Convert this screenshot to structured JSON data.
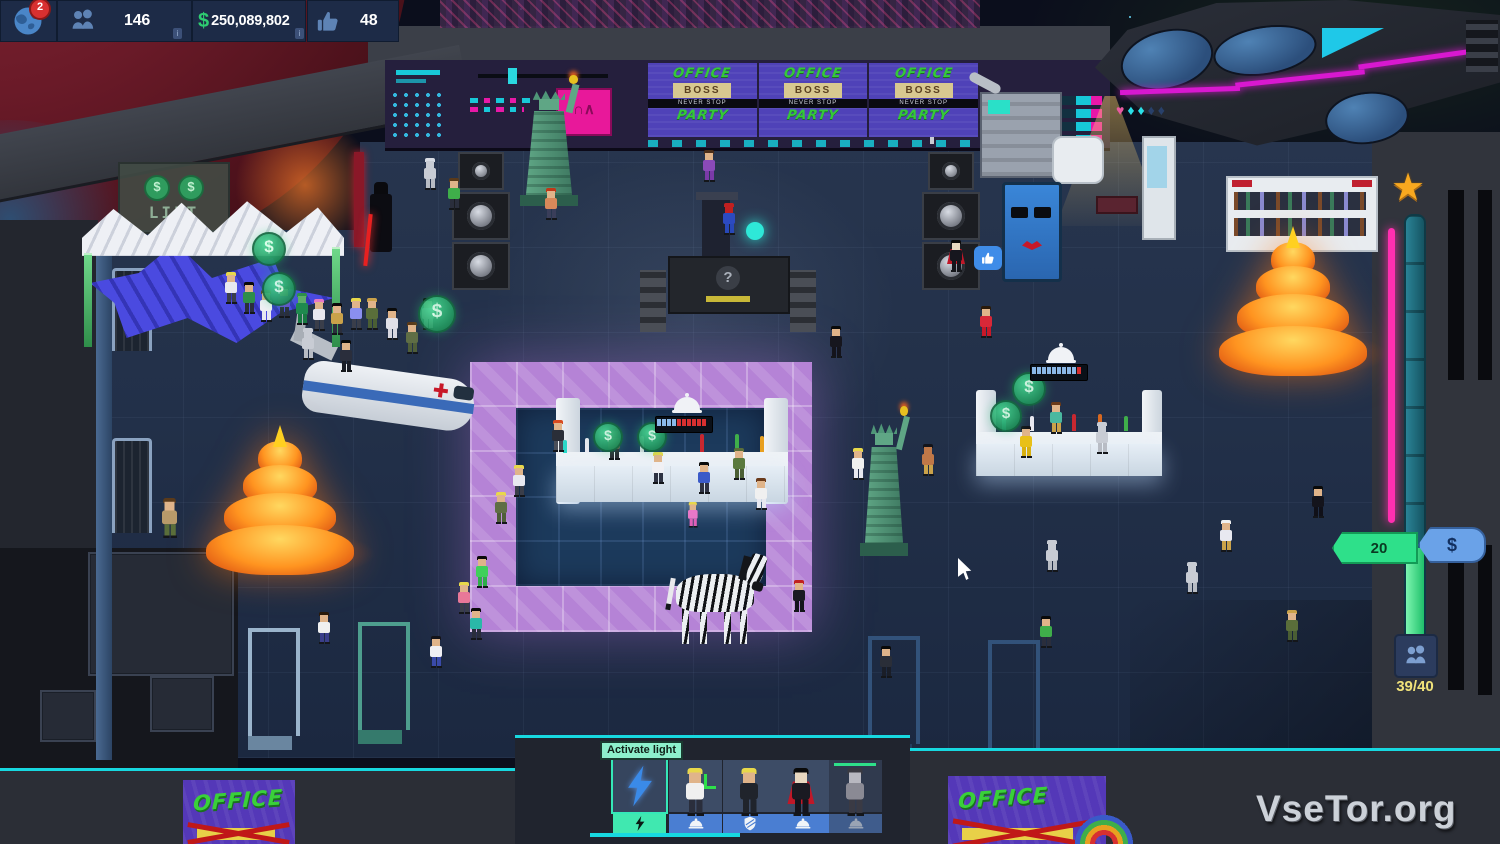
{
  "hud": {
    "notification_count": "2",
    "guests_count": "146",
    "currency_symbol": "$",
    "money": "250,089,802",
    "likes_count": "48",
    "info_chip": "i"
  },
  "signs": {
    "lift_label": "LIFT",
    "coin_symbol": "$",
    "billboard": {
      "top": "OFFICE",
      "boss": "BOSS",
      "strip": "NEVER STOP",
      "bottom": "PARTY",
      "count": 3
    },
    "poster_word": "OFFICE"
  },
  "djbooth": {
    "glyph": "?"
  },
  "console_screen_glyph": "∩∧",
  "tooltip_label": "Activate light",
  "toolbar": {
    "slots": [
      {
        "name": "activate-light",
        "icon": "lightning",
        "action_icon": "lightning",
        "selected": true
      },
      {
        "name": "staff-bartender",
        "icon": "portrait",
        "action_icon": "cloche",
        "selected": false
      },
      {
        "name": "staff-bouncer",
        "icon": "portrait",
        "action_icon": "shield",
        "selected": false
      },
      {
        "name": "staff-dracula",
        "icon": "portrait",
        "action_icon": "cloche",
        "selected": false
      },
      {
        "name": "staff-busy",
        "icon": "portrait",
        "action_icon": "cloche",
        "selected": false,
        "disabled": true
      }
    ]
  },
  "gauge": {
    "level_value": "20",
    "currency_symbol": "$",
    "capacity": "39/40",
    "diamond_glyphs": "♥♦♦♦♦"
  },
  "watermark": "VseTor.org",
  "colors": {
    "accent_teal": "#17d8e0",
    "accent_magenta": "#e818a8",
    "money_green": "#2ecc71",
    "hud_navy": "#1d2b47",
    "dancefloor_purple": "#b583d6",
    "gauge_pink": "#ff2fb0"
  },
  "scene": {
    "coin_symbol": "$",
    "characters": [
      {
        "x": 424,
        "y": 158,
        "hair": "#d8dce4",
        "skin": "#c8ccd4",
        "shirt": "#c8ccd4",
        "pants": "#b8bcc4"
      },
      {
        "x": 448,
        "y": 178,
        "hair": "#5a3a1a",
        "shirt": "#3fae4a",
        "pants": "#2a2e3c"
      },
      {
        "x": 545,
        "y": 188,
        "hair": "#c03818",
        "shirt": "#d8895a",
        "pants": "#3a3e5a"
      },
      {
        "x": 703,
        "y": 150,
        "hair": "#4a2e1a",
        "shirt": "#8a4ab8",
        "pants": "#7a3aa8"
      },
      {
        "x": 723,
        "y": 203,
        "hair": "#c02020",
        "skin": "#c02020",
        "shirt": "#2c4ac0",
        "pants": "#2848b8"
      },
      {
        "x": 950,
        "y": 240,
        "hair": "#0a0a0a",
        "skin": "#e8d8c0",
        "shirt": "#16161e",
        "pants": "#14141c",
        "cape": "#c01828"
      },
      {
        "x": 225,
        "y": 272,
        "hair": "#e8d84a",
        "shirt": "#e8e8f0",
        "pants": "#3a3e4a"
      },
      {
        "x": 243,
        "y": 282,
        "hair": "#0a0a0a",
        "shirt": "#2e8e4a",
        "pants": "#2a2e3c"
      },
      {
        "x": 260,
        "y": 290,
        "hair": "#6a3a1a",
        "shirt": "#f0f0f4",
        "pants": "#e8e8f0"
      },
      {
        "x": 278,
        "y": 286,
        "hair": "#0a0a0a",
        "shirt": "#6a4ad0",
        "pants": "#2a2e3c"
      },
      {
        "x": 296,
        "y": 293,
        "hair": "#2e8e4a",
        "skin": "#5fae6a",
        "shirt": "#1f8a4f",
        "pants": "#187a42"
      },
      {
        "x": 313,
        "y": 299,
        "hair": "#e878c8",
        "shirt": "#e8e8f0",
        "pants": "#3a3e4a"
      },
      {
        "x": 331,
        "y": 303,
        "hair": "#0a0a0a",
        "shirt": "#caa24a",
        "pants": "#2a2e3c"
      },
      {
        "x": 350,
        "y": 298,
        "hair": "#e8d84a",
        "shirt": "#8a8ff0",
        "pants": "#3a3e4a"
      },
      {
        "x": 302,
        "y": 328,
        "hair": "#c8ccd4",
        "skin": "#c8ccd4",
        "shirt": "#c8ccd4",
        "pants": "#b8bcc4"
      },
      {
        "x": 340,
        "y": 340,
        "hair": "#0a0a0a",
        "shirt": "#2a2e3c",
        "pants": "#1a1e28"
      },
      {
        "x": 366,
        "y": 298,
        "hair": "#caa24a",
        "shirt": "#5a6e3a",
        "pants": "#4a5e34"
      },
      {
        "x": 386,
        "y": 308,
        "hair": "#0a0a0a",
        "shirt": "#e0e0e8",
        "pants": "#d8d8e0"
      },
      {
        "x": 406,
        "y": 322,
        "hair": "#5a3a1a",
        "shirt": "#5f6e45",
        "pants": "#4f5e3a"
      },
      {
        "x": 422,
        "y": 298,
        "hair": "#0a0a0a",
        "shirt": "#f0f0f4",
        "pants": "#e8e8f0"
      },
      {
        "x": 162,
        "y": 498,
        "hair": "#5a3a1a",
        "shirt": "#b89a6a",
        "pants": "#5a6e3a",
        "s": 1.25
      },
      {
        "x": 552,
        "y": 420,
        "hair": "#d84a1f",
        "shirt": "#2a2e38",
        "pants": "#4a4e58"
      },
      {
        "x": 608,
        "y": 428,
        "hair": "#14141a",
        "skin": "#4a3a30",
        "shirt": "#6a5a48",
        "pants": "#2a2a32"
      },
      {
        "x": 495,
        "y": 492,
        "hair": "#e8d84a",
        "shirt": "#5f6e45",
        "pants": "#4f5e3a"
      },
      {
        "x": 513,
        "y": 465,
        "hair": "#e8d84a",
        "shirt": "#e8e8f0",
        "pants": "#3a3e4a"
      },
      {
        "x": 652,
        "y": 452,
        "hair": "#e8d84a",
        "shirt": "#f0f0f4",
        "pants": "#2e3242"
      },
      {
        "x": 698,
        "y": 462,
        "hair": "#0a0a0a",
        "shirt": "#3a5ac8",
        "pants": "#2e3242"
      },
      {
        "x": 733,
        "y": 448,
        "hair": "#5a6e3a",
        "shirt": "#5a7a3e",
        "pants": "#4a5e34"
      },
      {
        "x": 688,
        "y": 502,
        "hair": "#e8d84a",
        "shirt": "#e878c8",
        "pants": "#e060b8",
        "s": 0.8
      },
      {
        "x": 755,
        "y": 478,
        "hair": "#6a3a1a",
        "shirt": "#f0f0f0",
        "pants": "#e8e8f0"
      },
      {
        "x": 318,
        "y": 612,
        "hair": "#2a1a0a",
        "shirt": "#f0f0f0",
        "pants": "#3a3e8a"
      },
      {
        "x": 430,
        "y": 636,
        "hair": "#14141a",
        "shirt": "#f0f0f4",
        "pants": "#3a4aa8"
      },
      {
        "x": 476,
        "y": 556,
        "hair": "#0a0a0a",
        "shirt": "#3fd05a",
        "pants": "#2fae4a"
      },
      {
        "x": 458,
        "y": 582,
        "hair": "#e8d84a",
        "shirt": "#e87898",
        "pants": "#3a3e4a"
      },
      {
        "x": 470,
        "y": 608,
        "hair": "#0a0a0a",
        "shirt": "#2ab8a8",
        "pants": "#2a2e3c"
      },
      {
        "x": 793,
        "y": 580,
        "hair": "#c02020",
        "shirt": "#1a1a22",
        "pants": "#14141c"
      },
      {
        "x": 830,
        "y": 326,
        "hair": "#0a0a0a",
        "shirt": "#16161e",
        "pants": "#14141c"
      },
      {
        "x": 922,
        "y": 444,
        "hair": "#14141a",
        "skin": "#c07848",
        "shirt": "#c07848",
        "pants": "#caa24a"
      },
      {
        "x": 980,
        "y": 306,
        "hair": "#2a1a0a",
        "shirt": "#d82838",
        "pants": "#c81828"
      },
      {
        "x": 1020,
        "y": 426,
        "hair": "#14141a",
        "shirt": "#e8c018",
        "pants": "#d8b010"
      },
      {
        "x": 1050,
        "y": 402,
        "hair": "#6a3a1a",
        "shirt": "#4ab8a0",
        "pants": "#caa24a"
      },
      {
        "x": 852,
        "y": 448,
        "hair": "#e8d84a",
        "shirt": "#f0f0f0",
        "pants": "#e8e8f0"
      },
      {
        "x": 1096,
        "y": 422,
        "hair": "#c8ccd4",
        "skin": "#c8ccd4",
        "shirt": "#c8ccd4",
        "pants": "#b8bcc4"
      },
      {
        "x": 1046,
        "y": 540,
        "hair": "#c8ccd4",
        "skin": "#c8ccd4",
        "shirt": "#c8ccd4",
        "pants": "#b8bcc4"
      },
      {
        "x": 1186,
        "y": 562,
        "hair": "#c8ccd4",
        "skin": "#c8ccd4",
        "shirt": "#c8ccd4",
        "pants": "#b8bcc4"
      },
      {
        "x": 1220,
        "y": 520,
        "hair": "#f0f0f0",
        "shirt": "#e8e8f0",
        "pants": "#caa24a"
      },
      {
        "x": 1312,
        "y": 486,
        "hair": "#0a0a0a",
        "shirt": "#14141c",
        "pants": "#101018"
      },
      {
        "x": 1286,
        "y": 610,
        "hair": "#caa24a",
        "shirt": "#5a6e3a",
        "pants": "#4a5e34"
      },
      {
        "x": 1040,
        "y": 616,
        "hair": "#0a0a0a",
        "shirt": "#3fae4a",
        "pants": "#2a2e3c"
      },
      {
        "x": 880,
        "y": 646,
        "hair": "#0a0a0a",
        "shirt": "#2a2e38",
        "pants": "#1a1e28"
      }
    ],
    "portraits": [
      {
        "x": 686,
        "y": 768,
        "hair": "#e8d84a",
        "shirt": "#f0f0f0",
        "pants": "#2a2e3c",
        "s": 1.5,
        "acc": "cross"
      },
      {
        "x": 740,
        "y": 768,
        "hair": "#e8d84a",
        "shirt": "#20242c",
        "pants": "#20242c",
        "s": 1.5
      },
      {
        "x": 792,
        "y": 768,
        "hair": "#0a0a0a",
        "skin": "#e8d8c0",
        "shirt": "#1a1a22",
        "pants": "#14141c",
        "cape": "#c01828",
        "s": 1.5
      },
      {
        "x": 846,
        "y": 768,
        "hair": "#3a3a42",
        "skin": "#b8b8c0",
        "shirt": "#8a8a94",
        "pants": "#3a3a44",
        "s": 1.5
      }
    ],
    "coins": [
      {
        "x": 252,
        "y": 232,
        "s": 30
      },
      {
        "x": 262,
        "y": 272,
        "s": 30
      },
      {
        "x": 418,
        "y": 295,
        "s": 34
      },
      {
        "x": 593,
        "y": 422,
        "s": 26
      },
      {
        "x": 637,
        "y": 422,
        "s": 26
      },
      {
        "x": 1012,
        "y": 372,
        "s": 30
      },
      {
        "x": 990,
        "y": 400,
        "s": 28
      }
    ],
    "progress_bars": [
      {
        "x": 655,
        "y": 416,
        "blue": 4,
        "red": 6
      },
      {
        "x": 1030,
        "y": 364,
        "blue": 9,
        "red": 1
      }
    ],
    "cloches": [
      {
        "x": 672,
        "y": 396
      },
      {
        "x": 1046,
        "y": 346
      }
    ],
    "bottles": [
      {
        "x": 563,
        "y": 440,
        "h": 13,
        "c": "#2ad8c8"
      },
      {
        "x": 585,
        "y": 438,
        "h": 14,
        "c": "#e8e8f0"
      },
      {
        "x": 640,
        "y": 436,
        "h": 16,
        "c": "#d8d8e0"
      },
      {
        "x": 700,
        "y": 434,
        "h": 18,
        "c": "#c82830"
      },
      {
        "x": 735,
        "y": 434,
        "h": 18,
        "c": "#3fae4a"
      },
      {
        "x": 760,
        "y": 436,
        "h": 16,
        "c": "#e8a020"
      },
      {
        "x": 1002,
        "y": 418,
        "h": 13,
        "c": "#2ad8c8"
      },
      {
        "x": 1030,
        "y": 416,
        "h": 15,
        "c": "#e8e8f0"
      },
      {
        "x": 1072,
        "y": 414,
        "h": 17,
        "c": "#c82830"
      },
      {
        "x": 1098,
        "y": 414,
        "h": 17,
        "c": "#d86820"
      },
      {
        "x": 1124,
        "y": 416,
        "h": 15,
        "c": "#3fae4a"
      }
    ]
  }
}
